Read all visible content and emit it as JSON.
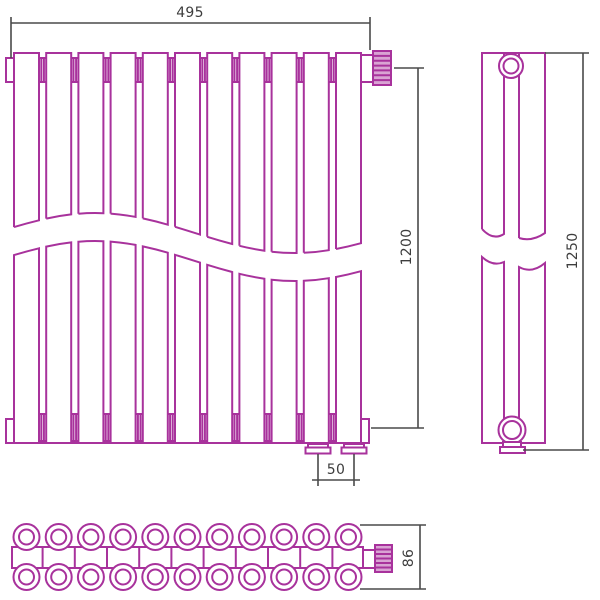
{
  "drawing": {
    "type": "technical-drawing",
    "sections": 11,
    "dimensions": {
      "width": "495",
      "height": "1200",
      "overall_height": "1250",
      "connection_spacing": "50",
      "depth": "86"
    },
    "colors": {
      "outline": "#a8329c",
      "knurl_fill": "#d9a3d3",
      "dimension_lines": "#4a4a4a",
      "text": "#3d3d3d",
      "background": "#ffffff"
    }
  }
}
